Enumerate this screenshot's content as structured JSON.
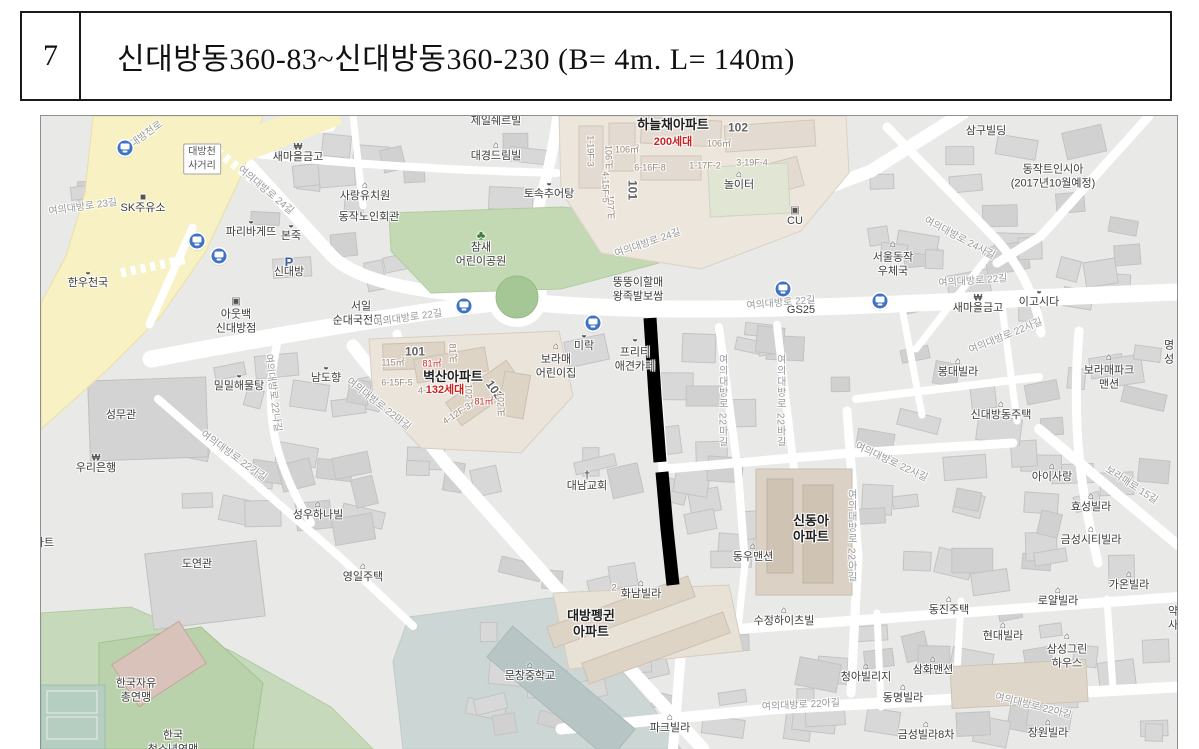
{
  "header": {
    "row_no": "7",
    "title": "신대방동360-83~신대방동360-230 (B= 4m. L= 140m)"
  },
  "map": {
    "colors": {
      "background": "#e9e9e7",
      "major_road": "#f8f1c3",
      "park_green": "#c3d9b4",
      "highlight": "#000000",
      "apartment_beige": "#ece6dd"
    },
    "highlight": {
      "width": 13,
      "color": "#000000",
      "segments": [
        [
          [
            649,
            317
          ],
          [
            654,
            395
          ],
          [
            659,
            461
          ]
        ],
        [
          [
            661,
            471
          ],
          [
            666,
            528
          ],
          [
            672,
            584
          ]
        ]
      ]
    },
    "bus_stops": [
      [
        124,
        147
      ],
      [
        196,
        240
      ],
      [
        218,
        255
      ],
      [
        463,
        305
      ],
      [
        592,
        322
      ],
      [
        782,
        288
      ],
      [
        879,
        300
      ]
    ],
    "labels": [
      {
        "t": "대방천로",
        "x": 146,
        "y": 134,
        "cls": "road",
        "rot": -36
      },
      {
        "t": "대방천\n사거리",
        "x": 201,
        "y": 158,
        "cls": "boxed"
      },
      {
        "t": "새마을금고",
        "x": 297,
        "y": 157,
        "icon": "bank"
      },
      {
        "t": "SK주유소",
        "x": 142,
        "y": 208,
        "icon": "gas"
      },
      {
        "t": "여의대방로 23길",
        "x": 82,
        "y": 207,
        "cls": "road",
        "rot": -8
      },
      {
        "t": "파리바게뜨",
        "x": 250,
        "y": 232,
        "icon": "food"
      },
      {
        "t": "본죽",
        "x": 290,
        "y": 236,
        "icon": "food"
      },
      {
        "t": "신대방",
        "x": 288,
        "y": 272,
        "icon": "parking"
      },
      {
        "t": "한우천국",
        "x": 87,
        "y": 283,
        "icon": "food"
      },
      {
        "t": "아웃백\n신대방점",
        "x": 235,
        "y": 321,
        "icon": "store"
      },
      {
        "t": "서일\n순대국전문2",
        "x": 360,
        "y": 313
      },
      {
        "t": "여의대방로 24길",
        "x": 264,
        "y": 190,
        "cls": "road",
        "rot": 40
      },
      {
        "t": "사랑유치원",
        "x": 364,
        "y": 196,
        "icon": "house"
      },
      {
        "t": "동작노인회관",
        "x": 368,
        "y": 217
      },
      {
        "t": "제일쉐르빌",
        "x": 495,
        "y": 121
      },
      {
        "t": "대경드림빌",
        "x": 495,
        "y": 156,
        "icon": "house"
      },
      {
        "t": "토속추어탕",
        "x": 548,
        "y": 194,
        "icon": "food"
      },
      {
        "t": "참새\n어린이공원",
        "x": 480,
        "y": 254,
        "icon": "tree"
      },
      {
        "t": "여의대방로 22길",
        "x": 407,
        "y": 318,
        "cls": "road",
        "rot": -8
      },
      {
        "t": "코오롱하늘채",
        "x": 672,
        "y": 109,
        "cls": "big"
      },
      {
        "t": "하늘채아파트",
        "x": 672,
        "y": 124,
        "cls": "big"
      },
      {
        "t": "200세대",
        "x": 672,
        "y": 142,
        "cls": "red"
      },
      {
        "t": "102",
        "x": 737,
        "y": 127,
        "cls": "num"
      },
      {
        "t": "106㎡",
        "x": 626,
        "y": 149,
        "cls": "tiny"
      },
      {
        "t": "106㎡",
        "x": 718,
        "y": 143,
        "cls": "tiny"
      },
      {
        "t": "106㎡",
        "x": 607,
        "y": 156,
        "cls": "tinyv"
      },
      {
        "t": "101",
        "x": 631,
        "y": 189,
        "cls": "numv"
      },
      {
        "t": "107㎡",
        "x": 609,
        "y": 206,
        "cls": "tinyv"
      },
      {
        "t": "1-19F-3",
        "x": 589,
        "y": 150,
        "cls": "tinyv"
      },
      {
        "t": "4-15F-5",
        "x": 604,
        "y": 186,
        "cls": "tinyv"
      },
      {
        "t": "6-16F-8",
        "x": 649,
        "y": 167,
        "cls": "tiny"
      },
      {
        "t": "1-17F-2",
        "x": 704,
        "y": 165,
        "cls": "tiny"
      },
      {
        "t": "3-19F-4",
        "x": 751,
        "y": 162,
        "cls": "tiny"
      },
      {
        "t": "놀이터",
        "x": 738,
        "y": 185,
        "icon": "play"
      },
      {
        "t": "CU",
        "x": 794,
        "y": 221,
        "icon": "store"
      },
      {
        "t": "삼구빌딩",
        "x": 985,
        "y": 131
      },
      {
        "t": "동작트인시아\n(2017년10월예정)",
        "x": 1052,
        "y": 176
      },
      {
        "t": "서울동작\n우체국",
        "x": 892,
        "y": 264,
        "icon": "house"
      },
      {
        "t": "여의대방로 24사길",
        "x": 958,
        "y": 238,
        "cls": "road",
        "rot": 28
      },
      {
        "t": "여의대방로 22사길",
        "x": 1005,
        "y": 336,
        "cls": "road",
        "rot": -22
      },
      {
        "t": "여의대방로 22길",
        "x": 972,
        "y": 281,
        "cls": "road",
        "rot": -4
      },
      {
        "t": "새마을금고",
        "x": 977,
        "y": 308,
        "icon": "bank"
      },
      {
        "t": "이고시다",
        "x": 1038,
        "y": 302,
        "icon": "food"
      },
      {
        "t": "GS25",
        "x": 800,
        "y": 310
      },
      {
        "t": "뚱뚱이할매\n왕족발보쌈",
        "x": 637,
        "y": 289
      },
      {
        "t": "여의대방로 22길",
        "x": 780,
        "y": 303,
        "cls": "road",
        "rot": -5
      },
      {
        "t": "여의대방로 24길",
        "x": 647,
        "y": 243,
        "cls": "road",
        "rot": -19
      },
      {
        "t": "미락",
        "x": 583,
        "y": 346,
        "icon": "food"
      },
      {
        "t": "보라매\n어린이집",
        "x": 555,
        "y": 366,
        "icon": "house"
      },
      {
        "t": "프리티\n애견카페",
        "x": 634,
        "y": 359,
        "icon": "food"
      },
      {
        "t": "대남교회",
        "x": 586,
        "y": 486,
        "icon": "church"
      },
      {
        "t": "벽산아파트",
        "x": 452,
        "y": 376,
        "cls": "big"
      },
      {
        "t": "101",
        "x": 414,
        "y": 351,
        "cls": "num"
      },
      {
        "t": "115㎡",
        "x": 392,
        "y": 362,
        "cls": "tiny"
      },
      {
        "t": "81㎡",
        "x": 431,
        "y": 363,
        "cls": "redtiny"
      },
      {
        "t": "81㎡",
        "x": 451,
        "y": 352,
        "cls": "tinyv"
      },
      {
        "t": "6-15F-5",
        "x": 396,
        "y": 382,
        "cls": "tiny"
      },
      {
        "t": "4-",
        "x": 421,
        "y": 390,
        "cls": "tiny"
      },
      {
        "t": "132세대",
        "x": 444,
        "y": 390,
        "cls": "red"
      },
      {
        "t": "102",
        "x": 493,
        "y": 389,
        "cls": "num",
        "rot": 55
      },
      {
        "t": "102㎡",
        "x": 467,
        "y": 395,
        "cls": "tinyv"
      },
      {
        "t": "81㎡",
        "x": 483,
        "y": 401,
        "cls": "redtiny"
      },
      {
        "t": "102㎡",
        "x": 499,
        "y": 403,
        "cls": "tinyv"
      },
      {
        "t": "4-12F-3",
        "x": 456,
        "y": 413,
        "cls": "tiny",
        "rot": -33
      },
      {
        "t": "여의대방로 22마길",
        "x": 377,
        "y": 404,
        "cls": "road",
        "rot": 38
      },
      {
        "t": "밀밀해물탕",
        "x": 238,
        "y": 386,
        "icon": "food"
      },
      {
        "t": "남도향",
        "x": 325,
        "y": 378,
        "icon": "food"
      },
      {
        "t": "성무관",
        "x": 120,
        "y": 415
      },
      {
        "t": "우리은행",
        "x": 95,
        "y": 468,
        "icon": "bank"
      },
      {
        "t": "여의대방로 22나길",
        "x": 271,
        "y": 392,
        "cls": "road",
        "rot": 83
      },
      {
        "t": "여의대방로 22가길",
        "x": 232,
        "y": 456,
        "cls": "road",
        "rot": 36
      },
      {
        "t": "성우하나빌",
        "x": 317,
        "y": 515,
        "icon": "house"
      },
      {
        "t": "아파트",
        "x": 38,
        "y": 543
      },
      {
        "t": "봉대빌라",
        "x": 957,
        "y": 372,
        "icon": "house"
      },
      {
        "t": "신대방동주택",
        "x": 1000,
        "y": 415,
        "icon": "house"
      },
      {
        "t": "보라매파크\n맨션",
        "x": 1108,
        "y": 377,
        "icon": "house"
      },
      {
        "t": "명성",
        "x": 1168,
        "y": 352
      },
      {
        "t": "아이사랑",
        "x": 1051,
        "y": 477,
        "icon": "house"
      },
      {
        "t": "효성빌라",
        "x": 1090,
        "y": 507,
        "icon": "house"
      },
      {
        "t": "금성시티빌라",
        "x": 1090,
        "y": 540,
        "icon": "house"
      },
      {
        "t": "보라매로 15길",
        "x": 1130,
        "y": 485,
        "cls": "road",
        "rot": 33
      },
      {
        "t": "여의대방로 22마길",
        "x": 720,
        "y": 400,
        "cls": "roadv"
      },
      {
        "t": "여의대방로 22바길",
        "x": 778,
        "y": 400,
        "cls": "roadv"
      },
      {
        "t": "여의대방로 22아길",
        "x": 849,
        "y": 535,
        "cls": "roadv"
      },
      {
        "t": "여의대방로 22사길",
        "x": 890,
        "y": 462,
        "cls": "road",
        "rot": 25
      },
      {
        "t": "신동아\n아파트",
        "x": 810,
        "y": 528,
        "cls": "big"
      },
      {
        "t": "동우맨션",
        "x": 752,
        "y": 557,
        "icon": "house"
      },
      {
        "t": "도연관",
        "x": 196,
        "y": 564
      },
      {
        "t": "영일주택",
        "x": 362,
        "y": 577,
        "icon": "house"
      },
      {
        "t": "한국자유\n총연맹",
        "x": 135,
        "y": 690
      },
      {
        "t": "한국\n청소년연맹",
        "x": 172,
        "y": 742
      },
      {
        "t": "문창중학교",
        "x": 529,
        "y": 676,
        "icon": "school"
      },
      {
        "t": "대방펭귄\n아파트",
        "x": 590,
        "y": 623,
        "cls": "big"
      },
      {
        "t": "2",
        "x": 613,
        "y": 587,
        "cls": "tiny"
      },
      {
        "t": "화남빌라",
        "x": 640,
        "y": 594,
        "icon": "house"
      },
      {
        "t": "수정하이츠빌",
        "x": 783,
        "y": 621,
        "icon": "house"
      },
      {
        "t": "동진주택",
        "x": 948,
        "y": 610,
        "icon": "house"
      },
      {
        "t": "로얄빌라",
        "x": 1057,
        "y": 601,
        "icon": "house"
      },
      {
        "t": "가온빌라",
        "x": 1128,
        "y": 585,
        "icon": "house"
      },
      {
        "t": "현대빌라",
        "x": 1002,
        "y": 636,
        "icon": "house"
      },
      {
        "t": "삼성그린\n하우스",
        "x": 1066,
        "y": 656,
        "icon": "house"
      },
      {
        "t": "약사",
        "x": 1172,
        "y": 618
      },
      {
        "t": "청아빌리지",
        "x": 865,
        "y": 677,
        "icon": "house"
      },
      {
        "t": "삼화맨션",
        "x": 932,
        "y": 670,
        "icon": "house"
      },
      {
        "t": "동명빌라",
        "x": 902,
        "y": 698,
        "icon": "house"
      },
      {
        "t": "금성빌라8차",
        "x": 925,
        "y": 735,
        "icon": "house"
      },
      {
        "t": "장원빌라",
        "x": 1047,
        "y": 733,
        "icon": "house"
      },
      {
        "t": "파크빌라",
        "x": 669,
        "y": 728,
        "icon": "house"
      },
      {
        "t": "여의대방로 22아길",
        "x": 800,
        "y": 705,
        "cls": "road",
        "rot": -3
      },
      {
        "t": "여의대방로 22아길",
        "x": 1032,
        "y": 706,
        "cls": "road",
        "rot": 14
      }
    ]
  }
}
